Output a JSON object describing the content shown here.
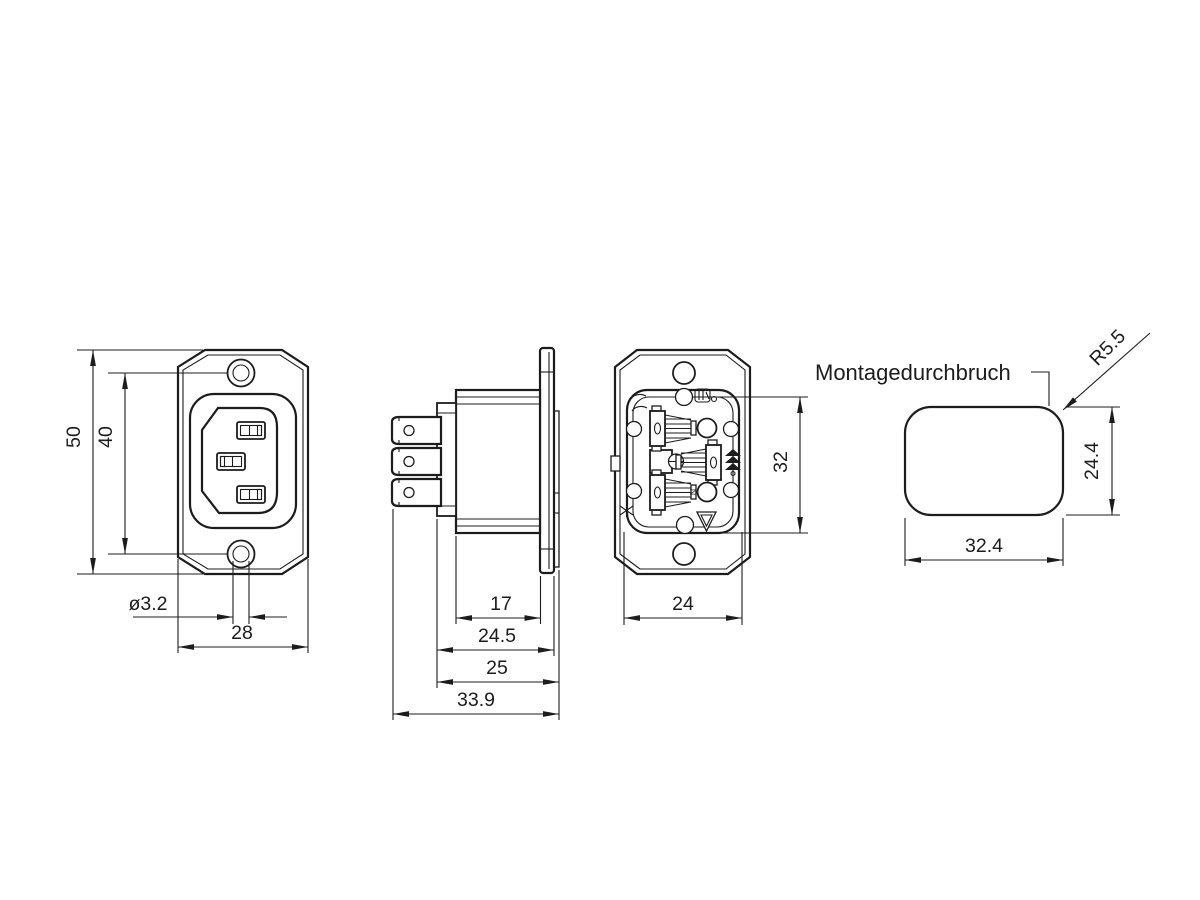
{
  "style": {
    "line_color": "#1c1c1c",
    "background": "#ffffff"
  },
  "views": {
    "front": {
      "dim_overall_height": "50",
      "dim_hole_spacing": "40",
      "dim_hole_diameter": "ø3.2",
      "dim_flange_width": "28"
    },
    "side": {
      "dim_body_depth": "17",
      "dim_depth_behind_panel": "24.5",
      "dim_depth_with_flange": "25",
      "dim_overall_depth": "33.9"
    },
    "rear": {
      "dim_body_height": "32",
      "dim_body_width": "24",
      "label_neutral": "N"
    },
    "cutout": {
      "label": "Montagedurchbruch",
      "dim_corner_radius": "R5.5",
      "dim_height": "24.4",
      "dim_width": "32.4"
    }
  }
}
